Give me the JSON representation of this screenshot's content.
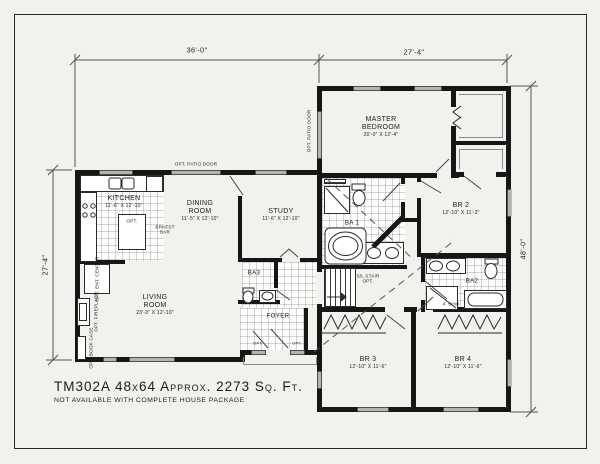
{
  "page": {
    "title": "TM302A  48x64  Approx. 2273 Sq. Ft.",
    "note": "NOT AVAILABLE WITH COMPLETE HOUSE PACKAGE"
  },
  "dimensions": {
    "left_wing_width": "36'-0\"",
    "right_wing_width": "27'-4\"",
    "left_wing_depth": "27'-4\"",
    "right_wing_depth": "48'-0\""
  },
  "rooms": {
    "kitchen": {
      "name": "KITCHEN",
      "size": "11'-6\" X 12'-10\""
    },
    "dining": {
      "name": "DINING ROOM",
      "size": "11'-5\" X 12'-10\""
    },
    "study": {
      "name": "STUDY",
      "size": "11'-6\" X 12'-10\""
    },
    "living": {
      "name": "LIVING ROOM",
      "size": "23'-3\" X 12'-10\""
    },
    "master": {
      "name": "MASTER BEDROOM",
      "size": "20'-0\" X 12'-4\""
    },
    "br2": {
      "name": "BR 2",
      "size": "12'-10\" X 11'-3\""
    },
    "br3": {
      "name": "BR 3",
      "size": "12'-10\" X 11'-6\""
    },
    "br4": {
      "name": "BR 4",
      "size": "12'-10\" X 11'-6\""
    },
    "foyer": {
      "name": "FOYER"
    },
    "ba1": {
      "name": "BA 1"
    },
    "ba2": {
      "name": "BA2"
    },
    "ba3": {
      "name": "BA3"
    }
  },
  "labels": {
    "opt_patio_door_top": "OPT. PATIO DOOR",
    "opt_patio_door_side": "OPT. PATIO DOOR",
    "opt_ent_center": "OPT. ENT. CENTER",
    "opt_fireplace": "OPT. FIREPLACE",
    "opt_book_case": "OPT. BOOK CASE",
    "opt_island": "OPT.",
    "brkfst_bar": "BRKFST BAR",
    "sl_stair_opt": "S/L STAIR OPT.",
    "shower": "4' SHW",
    "opt_front_1": "OPT.",
    "opt_front_2": "OPT."
  },
  "colors": {
    "wall": "#161616",
    "line": "#444444",
    "paper": "#f2f1ee",
    "window": "#b3b3b3"
  }
}
